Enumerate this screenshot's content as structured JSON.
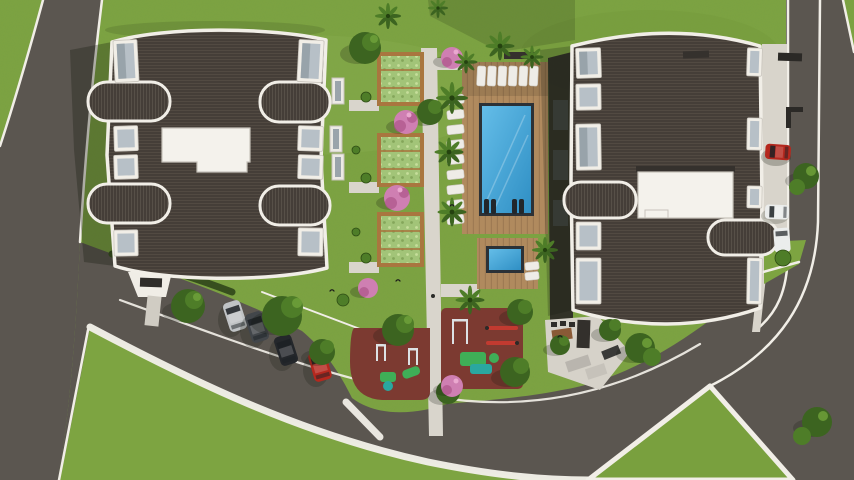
{
  "scene": {
    "description": "Aerial top-down 3D architectural rendering of a residential complex: two apartment buildings with dark barrel roofs, a central landscaped courtyard with swimming pool, kids pool, sun loungers, pergola garden beds, two rubber-surfaced playgrounds, an angled parking lot with cars, and surrounding asphalt roads with white curbs and a grass traffic island.",
    "site": {
      "buildings": 2,
      "swimming_pools": 2,
      "playgrounds": 2,
      "garden_beds": 3,
      "parked_cars_lot": 4,
      "cars_driveway": 3,
      "sun_loungers_poolside": 9,
      "sun_loungers_top_row": 6,
      "roads": 3,
      "grass_islands": 2
    },
    "colors": {
      "grassBase": "#7da441",
      "grassLight": "#92b455",
      "grassDark": "#6b8f36",
      "asphalt": "#5b5650",
      "trim": "#f1eee7",
      "sidewalk": "#ece8df",
      "roofDark": "#453e38",
      "roofLine": "#575048",
      "glass": "#b7c0c7",
      "deck": "#b08a5e",
      "deckLine": "#97744e",
      "water": "#45a8d8",
      "waterDeep": "#2e8ec0",
      "poolRim": "#2c3136",
      "rubber": "#7c3a31",
      "bedGreen": "#a2c478",
      "wood": "#a9763f",
      "walk": "#d9d5cc",
      "concrete": "#d8d4cb",
      "pink": "#cf7fb2",
      "pinkDark": "#ad5489",
      "treeDark": "#3c6420",
      "treeMid": "#4e7d28",
      "treeLight": "#6fa03a",
      "play1": "#3fae57",
      "play2": "#2aa7a0",
      "gym": "#c23a30",
      "carSilver": "#c0c3c5",
      "carDark": "#42464a",
      "carBlack": "#24272b",
      "carRed": "#b5281e",
      "carWhite": "#ebedec"
    }
  }
}
